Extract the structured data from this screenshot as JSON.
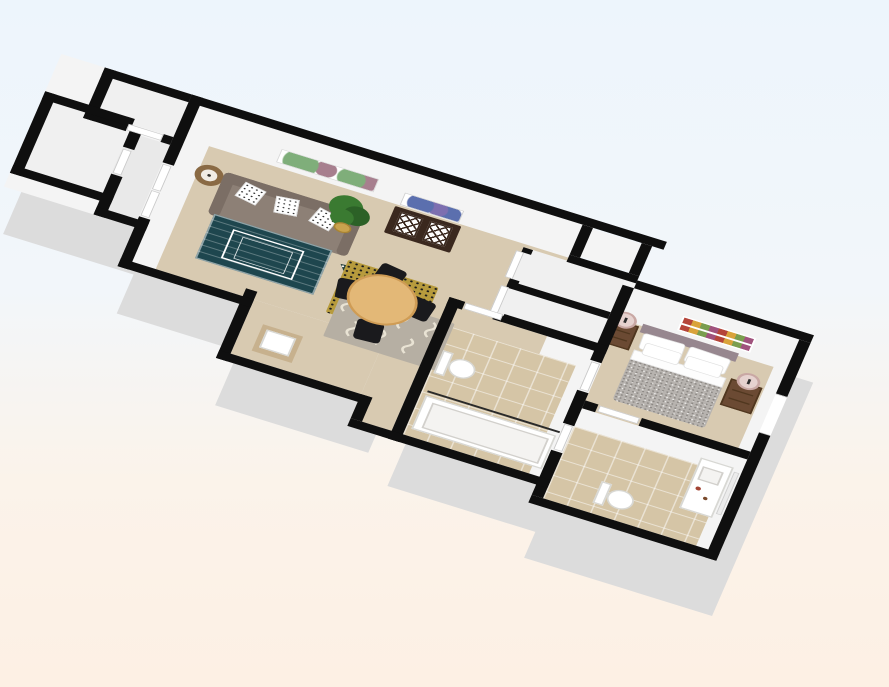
{
  "scene": {
    "type": "3d-floor-plan-render",
    "description": "Isometric 3D floor plan of a one-bedroom apartment viewed from above at an angle",
    "background": {
      "top": "#edf5fc",
      "mid": "#f2f6fa",
      "low": "#fbf3ea",
      "bottom": "#fdf0e4"
    }
  },
  "palette": {
    "bg-top": "#edf5fc",
    "bg-mid": "#f2f6fa",
    "bg-low": "#fbf3ea",
    "bg-bot": "#fdf0e4",
    "wall": "#0f0f0f",
    "wall-face": "#f4f4f4",
    "wall-side": "#dcdcdc",
    "floor": "#d8cab1",
    "tile": "#d5c5a6",
    "closet-floor": "#f0f0f0",
    "entry-floor": "#e9e9e9",
    "door": "#ffffff",
    "door-edge": "#c9c9c9",
    "sofa": "#8d8076",
    "sofa-dark": "#7b6e65",
    "rug-teal": "#1e464e",
    "rug-tri": "#223d3b",
    "rug-yellow": "#b79b3d",
    "rug-gray": "#b6afa3",
    "rug-gray-wave": "#e9e3d4",
    "table-wood": "#e3b877",
    "table-edge": "#cf9c55",
    "chair": "#1a1a1d",
    "plant": "#3a7a31",
    "plant-dark": "#2c6127",
    "pot": "#c9a34e",
    "lamp-shade": "#8a6a44",
    "lamp-inner": "#f1ece4",
    "cabinet": "#3a281e",
    "art-green": "#7fae7a",
    "art-mauve": "#a77f8e",
    "art-blue": "#5b6fae",
    "art-blue2": "#7d6fb0",
    "art1": "#b5453a",
    "art2": "#d9a33b",
    "art3": "#7a9e4f",
    "art4": "#a0527d",
    "headboard": "#97878f",
    "duvet": "#b7b3af",
    "duvet-dot": "#8d8985",
    "wood": "#6b4a33",
    "wood-dark": "#50371f",
    "lamp-pink": "#e6d2cf",
    "lamp-pink-edge": "#c9a8a4",
    "porcelain": "#ffffff",
    "porcelain-edge": "#d8d8d4",
    "counter": "#c7b18e",
    "rod": "#2a2a2a"
  },
  "rooms": [
    {
      "name": "entry",
      "features": [
        "closet",
        "closet",
        "double-doors"
      ]
    },
    {
      "name": "living-room",
      "features": [
        "sofa",
        "floor-lamp",
        "plant",
        "wall-art",
        "teal-rug",
        "coffee-table",
        "accent-rug"
      ]
    },
    {
      "name": "dining-area",
      "features": [
        "round-table",
        "four-chairs",
        "yellow-rug",
        "gray-wave-rug",
        "lattice-cabinet",
        "wall-art"
      ]
    },
    {
      "name": "powder-nook",
      "features": [
        "pedestal-sink"
      ]
    },
    {
      "name": "hallway",
      "features": [
        "closet",
        "closet"
      ]
    },
    {
      "name": "bathroom",
      "features": [
        "toilet",
        "bathtub",
        "shower-rod",
        "tile-floor"
      ]
    },
    {
      "name": "bedroom",
      "features": [
        "double-bed",
        "headboard",
        "two-nightstands",
        "two-lamps",
        "wall-art",
        "window"
      ]
    },
    {
      "name": "ensuite-bathroom",
      "features": [
        "vanity-sink",
        "mirror",
        "toilet",
        "tile-floor"
      ]
    }
  ]
}
